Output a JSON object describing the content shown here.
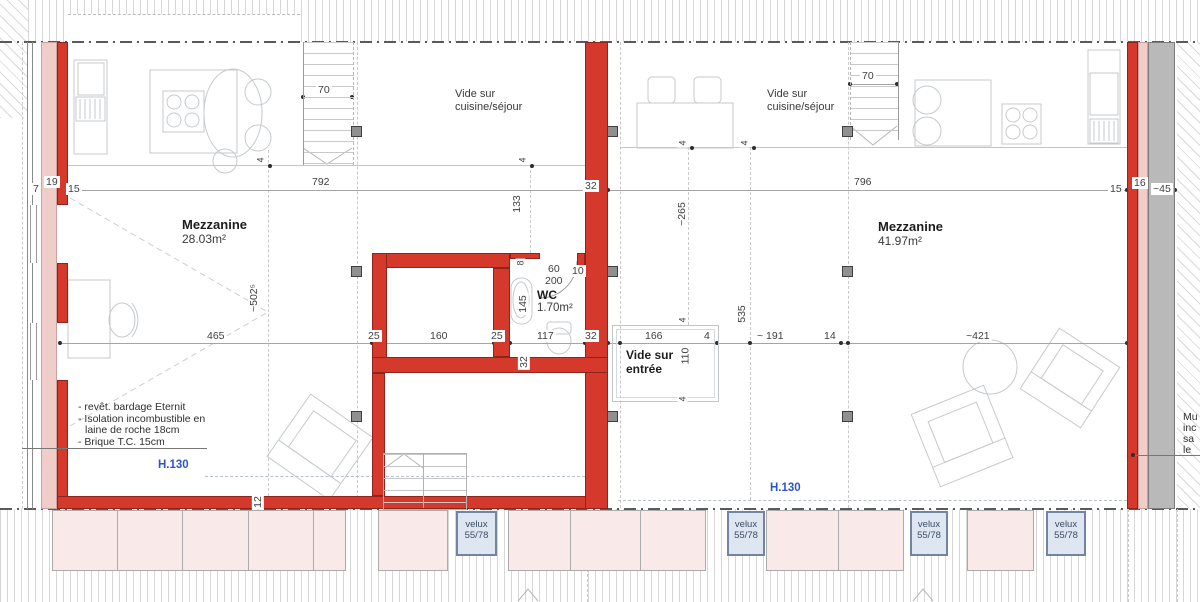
{
  "left_unit": {
    "name": "Mezzanine",
    "area": "28.03m²",
    "void_line1": "Vide sur",
    "void_line2": "cuisine/séjour",
    "height_label": "H.130"
  },
  "right_unit": {
    "name": "Mezzanine",
    "area": "41.97m²",
    "void_line1": "Vide sur",
    "void_line2": "cuisine/séjour",
    "entry_line1": "Vide sur",
    "entry_line2": "entrée",
    "height_label": "H.130"
  },
  "wc": {
    "name": "WC",
    "area": "1.70m²"
  },
  "notes": {
    "line1": "- revêt. bardage Eternit",
    "line2": "- Isolation incombustible en",
    "line3": "laine de roche 18cm",
    "line4": "- Brique T.C. 15cm"
  },
  "right_note": {
    "line1": "Mu",
    "line2": "inc",
    "line3": "sa",
    "line4": "le"
  },
  "velux": {
    "line1": "velux",
    "line2": "55/78"
  },
  "dims": {
    "d4": "4",
    "d7": "7",
    "d8": "8",
    "d10": "10",
    "d12": "12",
    "d14": "14",
    "d15": "15",
    "d16": "16",
    "d19": "19",
    "d25": "25",
    "d32": "32",
    "d45": "~45",
    "d60": "60",
    "d70": "70",
    "d110": "110",
    "d117": "117",
    "d133": "133",
    "d145": "145",
    "d160": "160",
    "d166": "166",
    "d191": "~ 191",
    "d200": "200",
    "d265": "~265",
    "d421": "~421",
    "d465": "465",
    "d502": "~502⁵",
    "d535": "535",
    "d792": "792",
    "d796": "796"
  },
  "colors": {
    "wall_red": "#d5392b",
    "wall_pink": "#f0cdc9",
    "wall_gray": "#b9b9b9",
    "height_blue": "#2d55c8",
    "velux_fill": "#dde6f1",
    "dormer_fill": "#f9e9e8"
  }
}
